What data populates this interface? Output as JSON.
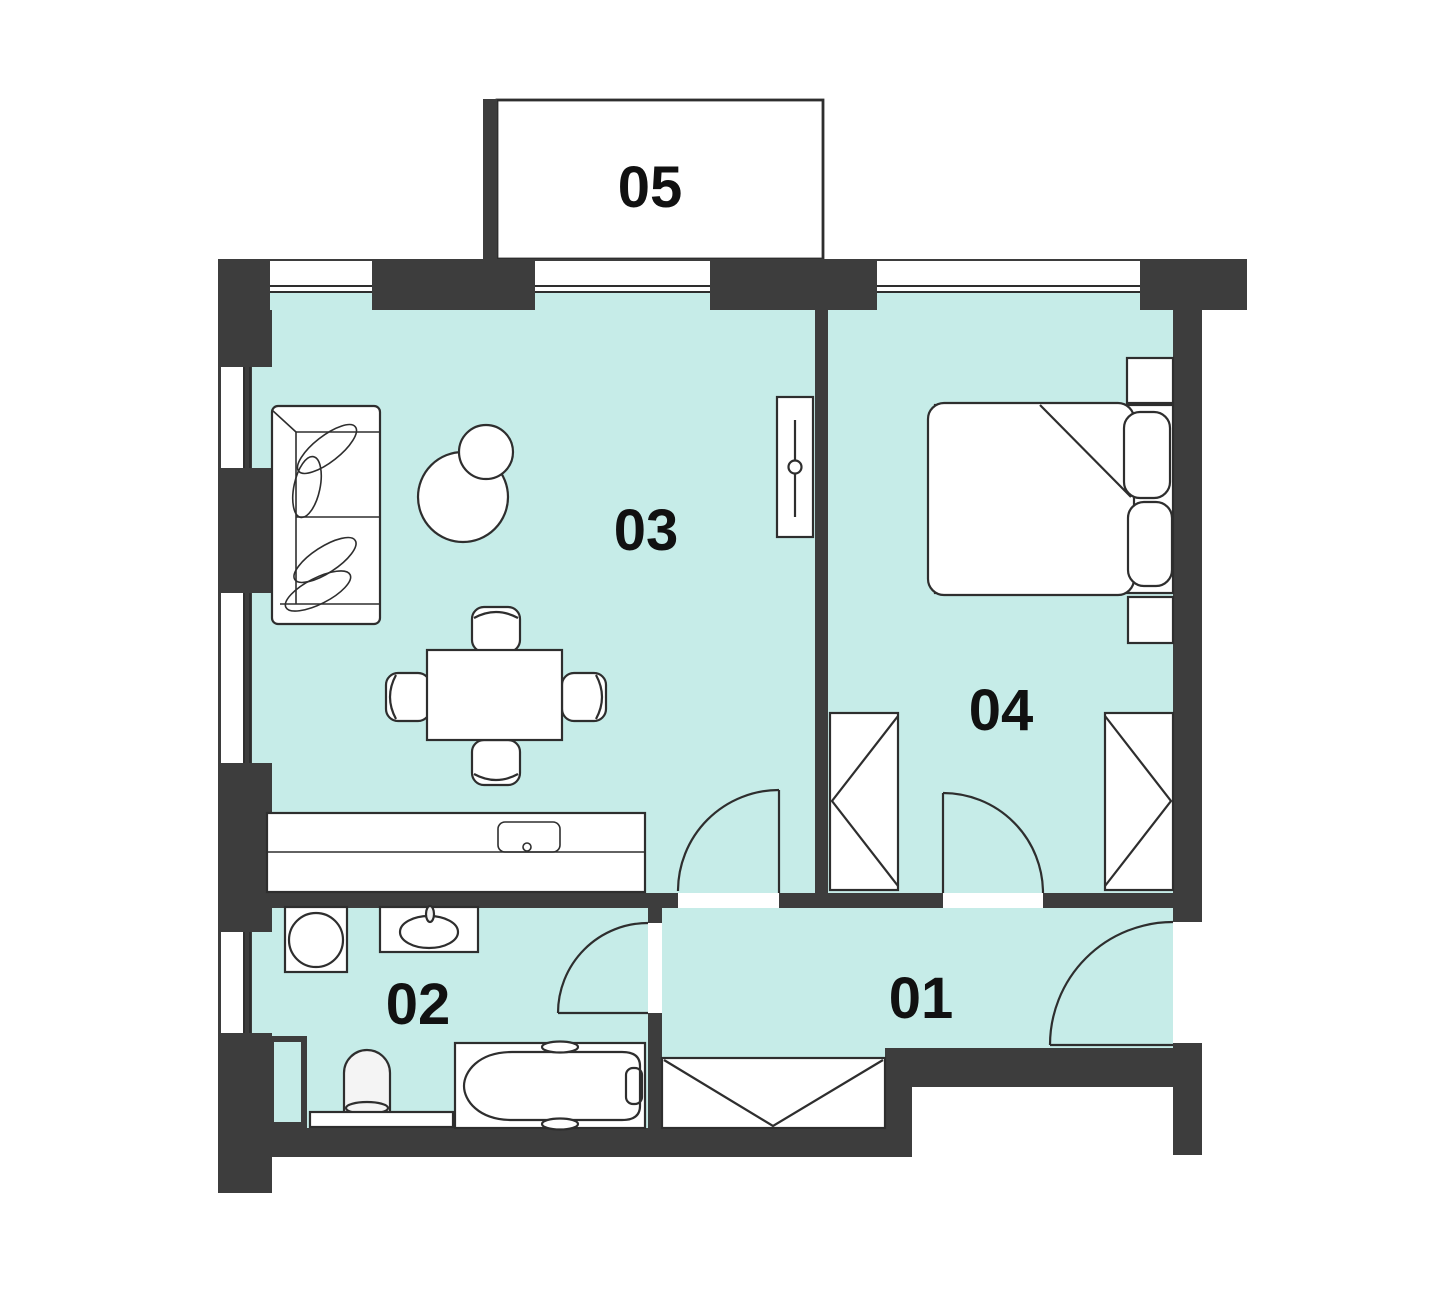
{
  "floor_plan": {
    "colors": {
      "background": "#ffffff",
      "room_fill": "#c6ece8",
      "wall": "#3d3d3d",
      "outline": "#2e2e2e",
      "label": "#111111"
    },
    "room_labels": {
      "hallway": "01",
      "bathroom": "02",
      "living_room": "03",
      "bedroom": "04",
      "balcony": "05"
    }
  }
}
